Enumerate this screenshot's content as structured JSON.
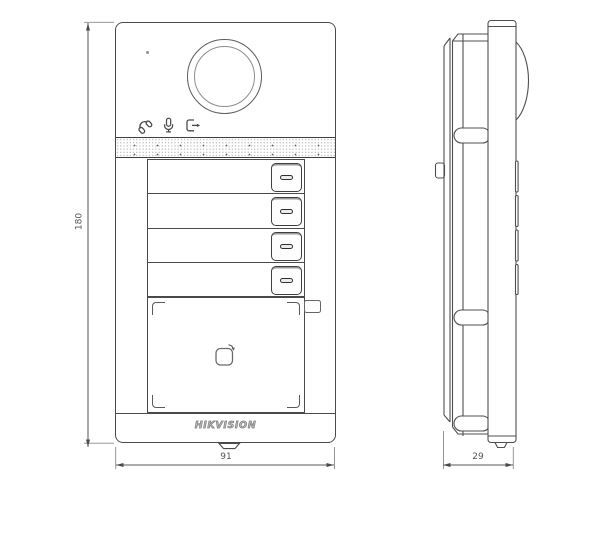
{
  "drawing": {
    "type": "technical-dimension-drawing",
    "views": [
      "front",
      "side"
    ]
  },
  "dimensions": {
    "height_mm": "180",
    "width_mm": "91",
    "depth_mm": "29"
  },
  "brand": {
    "logo_text": "HIKVISION"
  },
  "front_view": {
    "call_button_count": 4,
    "nameplate_row_count": 4,
    "icons": {
      "call": "call-icon",
      "microphone": "microphone-icon",
      "door_release": "door-release-icon",
      "card_tap": "card-tap-icon"
    }
  },
  "colors": {
    "background": "#ffffff",
    "line": "#4a4a4a",
    "line_light": "#8a8a8a",
    "dimension_text": "#555555",
    "logo": "#7a7a7a"
  }
}
